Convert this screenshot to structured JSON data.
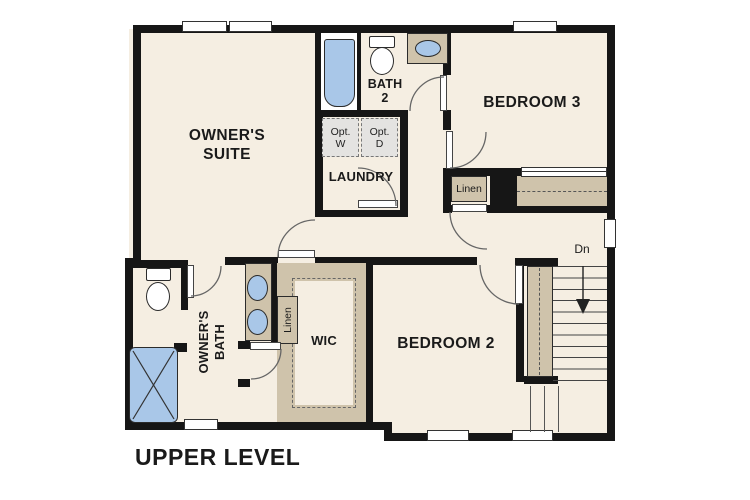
{
  "title": "UPPER LEVEL",
  "labels": {
    "owners_suite_1": "OWNER'S",
    "owners_suite_2": "SUITE",
    "bath2_1": "BATH",
    "bath2_2": "2",
    "laundry": "LAUNDRY",
    "bedroom3": "BEDROOM 3",
    "bedroom2": "BEDROOM 2",
    "wic": "WIC",
    "owners_bath_1": "OWNER'S",
    "owners_bath_2": "BATH",
    "linen_hall": "Linen",
    "linen_bath": "Linen",
    "opt_w_1": "Opt.",
    "opt_w_2": "W",
    "opt_d_1": "Opt.",
    "opt_d_2": "D",
    "stairs_down": "Dn",
    "level_title": "UPPER LEVEL"
  },
  "colors": {
    "wall": "#161616",
    "floor": "#f5eee2",
    "casework_tan": "#cfc3ab",
    "fixture_blue": "#a9c7e8",
    "optional_gray": "#e4e3e1"
  }
}
